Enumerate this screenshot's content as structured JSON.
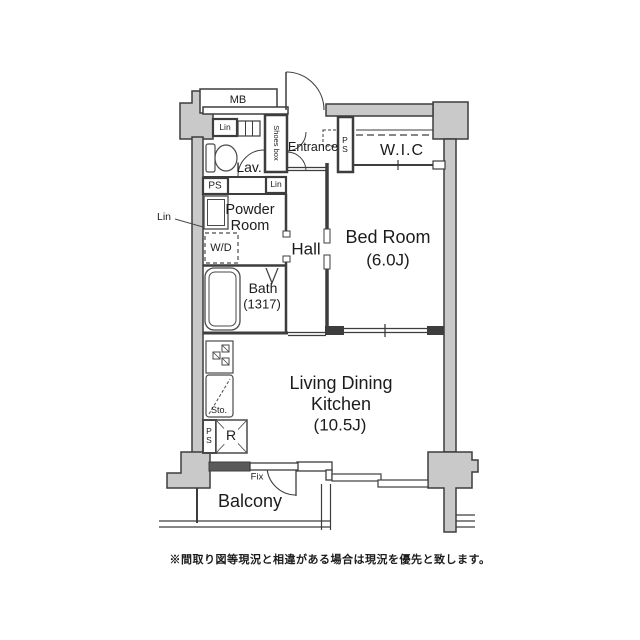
{
  "floorplan": {
    "rooms": {
      "entrance": "Entrance",
      "wic": "W.I.C",
      "lav": "Lav.",
      "powder_line1": "Powder",
      "powder_line2": "Room",
      "hall": "Hall",
      "bedroom_name": "Bed Room",
      "bedroom_size": "(6.0J)",
      "bath_name": "Bath",
      "bath_size": "(1317)",
      "ldk_line1": "Living Dining",
      "ldk_line2": "Kitchen",
      "ldk_size": "(10.5J)",
      "balcony": "Balcony"
    },
    "fixtures": {
      "mb": "MB",
      "lin_top": "Lin",
      "lin_mid": "Lin",
      "lin_outside": "Lin",
      "ps_top": "PS",
      "ps_shaft": "PS",
      "ps_bottom": "PS",
      "shoes_box": "Shoes box",
      "wd": "W/D",
      "sto": "Sto.",
      "refrigerator": "R",
      "fix_window": "Fix"
    },
    "note": "※間取り図等現況と相違がある場合は現況を優先と致します。",
    "colors": {
      "wall": "#3d3d3d",
      "pillar": "#c9c9c9",
      "text": "#1c1c1c"
    }
  }
}
